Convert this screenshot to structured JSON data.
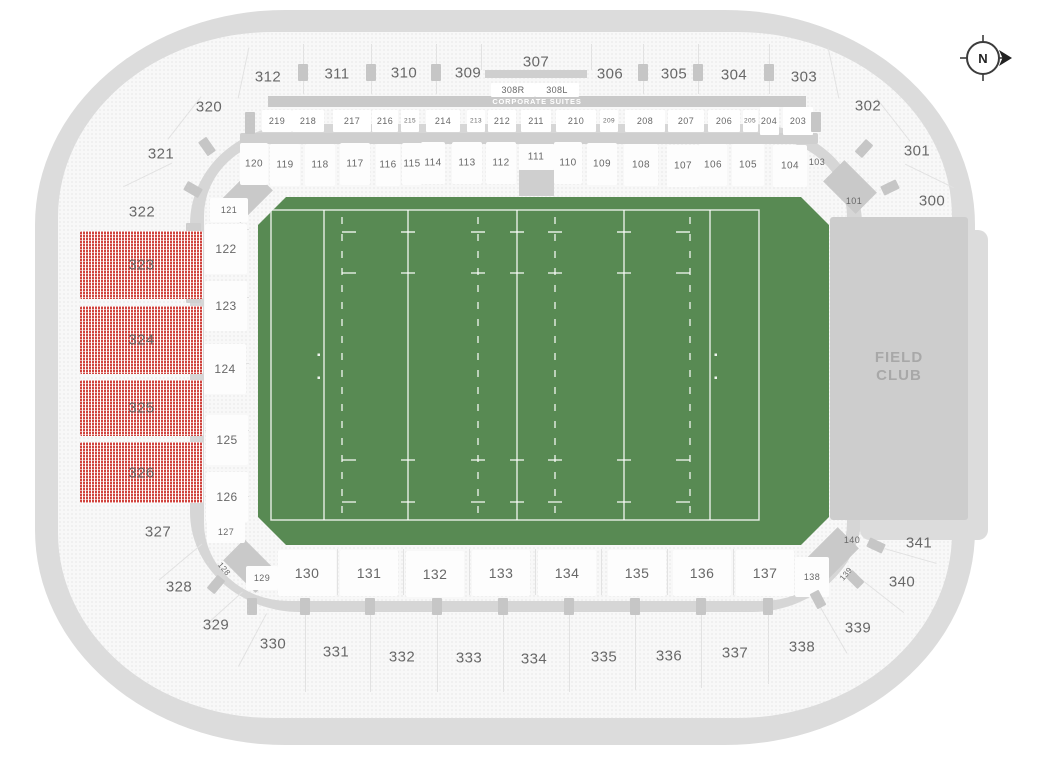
{
  "compass": {
    "label": "N"
  },
  "areas": {
    "corporate_suites": "CORPORATE SUITES",
    "field_club": "FIELD CLUB"
  },
  "colors": {
    "field_green": "#588a53",
    "premium_red": "#d0443e",
    "bowl_band": "#dcdcdc",
    "concourse": "#d6d6d6",
    "field_club_bg": "#cdcdcd",
    "suite_bar": "#c9c9c9",
    "label_gray": "#686868"
  },
  "sections": {
    "upper": [
      {
        "label": "312",
        "x": 268,
        "y": 77
      },
      {
        "label": "311",
        "x": 337,
        "y": 74
      },
      {
        "label": "310",
        "x": 404,
        "y": 73
      },
      {
        "label": "309",
        "x": 468,
        "y": 73
      },
      {
        "label": "307",
        "x": 536,
        "y": 62
      },
      {
        "label": "306",
        "x": 610,
        "y": 74
      },
      {
        "label": "305",
        "x": 674,
        "y": 74
      },
      {
        "label": "304",
        "x": 734,
        "y": 75
      },
      {
        "label": "303",
        "x": 804,
        "y": 77
      },
      {
        "label": "302",
        "x": 868,
        "y": 106
      },
      {
        "label": "301",
        "x": 917,
        "y": 151
      },
      {
        "label": "300",
        "x": 932,
        "y": 201
      },
      {
        "label": "320",
        "x": 209,
        "y": 107
      },
      {
        "label": "321",
        "x": 161,
        "y": 154
      },
      {
        "label": "322",
        "x": 142,
        "y": 212
      },
      {
        "label": "327",
        "x": 158,
        "y": 532
      },
      {
        "label": "328",
        "x": 179,
        "y": 587
      },
      {
        "label": "329",
        "x": 216,
        "y": 625
      },
      {
        "label": "330",
        "x": 273,
        "y": 644
      },
      {
        "label": "331",
        "x": 336,
        "y": 652
      },
      {
        "label": "332",
        "x": 402,
        "y": 657
      },
      {
        "label": "333",
        "x": 469,
        "y": 658
      },
      {
        "label": "334",
        "x": 534,
        "y": 659
      },
      {
        "label": "335",
        "x": 604,
        "y": 657
      },
      {
        "label": "336",
        "x": 669,
        "y": 656
      },
      {
        "label": "337",
        "x": 735,
        "y": 653
      },
      {
        "label": "338",
        "x": 802,
        "y": 647
      },
      {
        "label": "339",
        "x": 858,
        "y": 628
      },
      {
        "label": "340",
        "x": 902,
        "y": 582
      },
      {
        "label": "341",
        "x": 919,
        "y": 543
      }
    ],
    "suites": [
      {
        "label": "219",
        "x": 277,
        "w": 30
      },
      {
        "label": "218",
        "x": 308,
        "w": 32
      },
      {
        "label": "217",
        "x": 352,
        "w": 38
      },
      {
        "label": "216",
        "x": 385,
        "w": 26
      },
      {
        "label": "215",
        "x": 410,
        "w": 18,
        "fs": 6.5
      },
      {
        "label": "214",
        "x": 443,
        "w": 34
      },
      {
        "label": "213",
        "x": 476,
        "w": 18,
        "fs": 6.5
      },
      {
        "label": "212",
        "x": 502,
        "w": 28
      },
      {
        "label": "211",
        "x": 536,
        "w": 30
      },
      {
        "label": "210",
        "x": 576,
        "w": 40
      },
      {
        "label": "209",
        "x": 609,
        "w": 18,
        "fs": 6.5
      },
      {
        "label": "208",
        "x": 645,
        "w": 40
      },
      {
        "label": "207",
        "x": 686,
        "w": 36
      },
      {
        "label": "206",
        "x": 724,
        "w": 32
      },
      {
        "label": "205",
        "x": 750,
        "w": 15,
        "fs": 6.5
      },
      {
        "label": "204",
        "x": 769,
        "w": 19,
        "h": 28
      },
      {
        "label": "203",
        "x": 798,
        "w": 30,
        "h": 28
      },
      {
        "label": "308R",
        "x": 513,
        "y": 90,
        "w": 44,
        "h": 14
      },
      {
        "label": "308L",
        "x": 557,
        "y": 90,
        "w": 44,
        "h": 14
      }
    ],
    "lower": [
      {
        "label": "120",
        "x": 254,
        "y": 164,
        "fs": 10,
        "bw": 28,
        "bh": 42
      },
      {
        "label": "119",
        "x": 285,
        "y": 165,
        "fs": 10,
        "bw": 30,
        "bh": 42
      },
      {
        "label": "118",
        "x": 320,
        "y": 165,
        "fs": 10,
        "bw": 30,
        "bh": 42
      },
      {
        "label": "117",
        "x": 355,
        "y": 164,
        "fs": 10,
        "bw": 30,
        "bh": 42
      },
      {
        "label": "116",
        "x": 388,
        "y": 165,
        "fs": 10,
        "bw": 24,
        "bh": 42
      },
      {
        "label": "115",
        "x": 412,
        "y": 164,
        "fs": 10,
        "bw": 20,
        "bh": 42
      },
      {
        "label": "114",
        "x": 433,
        "y": 163,
        "fs": 10,
        "bw": 24,
        "bh": 42
      },
      {
        "label": "113",
        "x": 467,
        "y": 163,
        "fs": 10,
        "bw": 30,
        "bh": 42
      },
      {
        "label": "112",
        "x": 501,
        "y": 163,
        "fs": 10,
        "bw": 30,
        "bh": 42
      },
      {
        "label": "111",
        "x": 536,
        "y": 157,
        "fs": 10,
        "bw": 35,
        "bh": 26
      },
      {
        "label": "110",
        "x": 568,
        "y": 163,
        "fs": 10,
        "bw": 28,
        "bh": 42
      },
      {
        "label": "109",
        "x": 602,
        "y": 164,
        "fs": 10,
        "bw": 30,
        "bh": 42
      },
      {
        "label": "108",
        "x": 641,
        "y": 165,
        "fs": 10,
        "bw": 34,
        "bh": 42
      },
      {
        "label": "107",
        "x": 683,
        "y": 166,
        "fs": 10,
        "bw": 32,
        "bh": 42
      },
      {
        "label": "106",
        "x": 713,
        "y": 165,
        "fs": 10,
        "bw": 28,
        "bh": 42
      },
      {
        "label": "105",
        "x": 748,
        "y": 165,
        "fs": 10,
        "bw": 32,
        "bh": 42
      },
      {
        "label": "104",
        "x": 790,
        "y": 166,
        "fs": 10,
        "bw": 34,
        "bh": 42
      },
      {
        "label": "103",
        "x": 817,
        "y": 162,
        "fs": 9
      },
      {
        "label": "101",
        "x": 854,
        "y": 201,
        "fs": 9
      },
      {
        "label": "121",
        "x": 229,
        "y": 210,
        "fs": 9,
        "bw": 38,
        "bh": 24
      },
      {
        "label": "122",
        "x": 226,
        "y": 249,
        "fs": 12,
        "bw": 42,
        "bh": 50
      },
      {
        "label": "123",
        "x": 226,
        "y": 306,
        "fs": 12,
        "bw": 42,
        "bh": 50
      },
      {
        "label": "124",
        "x": 225,
        "y": 369,
        "fs": 12,
        "bw": 42,
        "bh": 50
      },
      {
        "label": "125",
        "x": 227,
        "y": 440,
        "fs": 12,
        "bw": 42,
        "bh": 50
      },
      {
        "label": "126",
        "x": 227,
        "y": 497,
        "fs": 12,
        "bw": 42,
        "bh": 50
      },
      {
        "label": "127",
        "x": 226,
        "y": 532,
        "fs": 9,
        "bw": 38,
        "bh": 22
      },
      {
        "label": "128",
        "x": 224,
        "y": 569,
        "fs": 8,
        "rot": 50
      },
      {
        "label": "129",
        "x": 262,
        "y": 578,
        "fs": 9,
        "bw": 32,
        "bh": 24
      },
      {
        "label": "130",
        "x": 307,
        "y": 573,
        "fs": 14,
        "bw": 58,
        "bh": 46
      },
      {
        "label": "131",
        "x": 369,
        "y": 573,
        "fs": 14,
        "bw": 58,
        "bh": 46
      },
      {
        "label": "132",
        "x": 435,
        "y": 574,
        "fs": 14,
        "bw": 58,
        "bh": 46
      },
      {
        "label": "133",
        "x": 501,
        "y": 573,
        "fs": 14,
        "bw": 58,
        "bh": 46
      },
      {
        "label": "134",
        "x": 567,
        "y": 573,
        "fs": 14,
        "bw": 58,
        "bh": 46
      },
      {
        "label": "135",
        "x": 637,
        "y": 573,
        "fs": 14,
        "bw": 58,
        "bh": 46
      },
      {
        "label": "136",
        "x": 702,
        "y": 573,
        "fs": 14,
        "bw": 58,
        "bh": 46
      },
      {
        "label": "137",
        "x": 765,
        "y": 573,
        "fs": 14,
        "bw": 58,
        "bh": 46
      },
      {
        "label": "138",
        "x": 812,
        "y": 577,
        "fs": 9,
        "bw": 34,
        "bh": 40
      },
      {
        "label": "139",
        "x": 846,
        "y": 574,
        "fs": 8,
        "rot": -50
      },
      {
        "label": "140",
        "x": 852,
        "y": 540,
        "fs": 9
      }
    ],
    "premium": [
      {
        "label": "323",
        "x": 80,
        "y": 231,
        "w": 123,
        "h": 68
      },
      {
        "label": "324",
        "x": 80,
        "y": 306,
        "w": 123,
        "h": 68
      },
      {
        "label": "325",
        "x": 80,
        "y": 380,
        "w": 123,
        "h": 56
      },
      {
        "label": "326",
        "x": 80,
        "y": 442,
        "w": 123,
        "h": 61
      }
    ]
  }
}
